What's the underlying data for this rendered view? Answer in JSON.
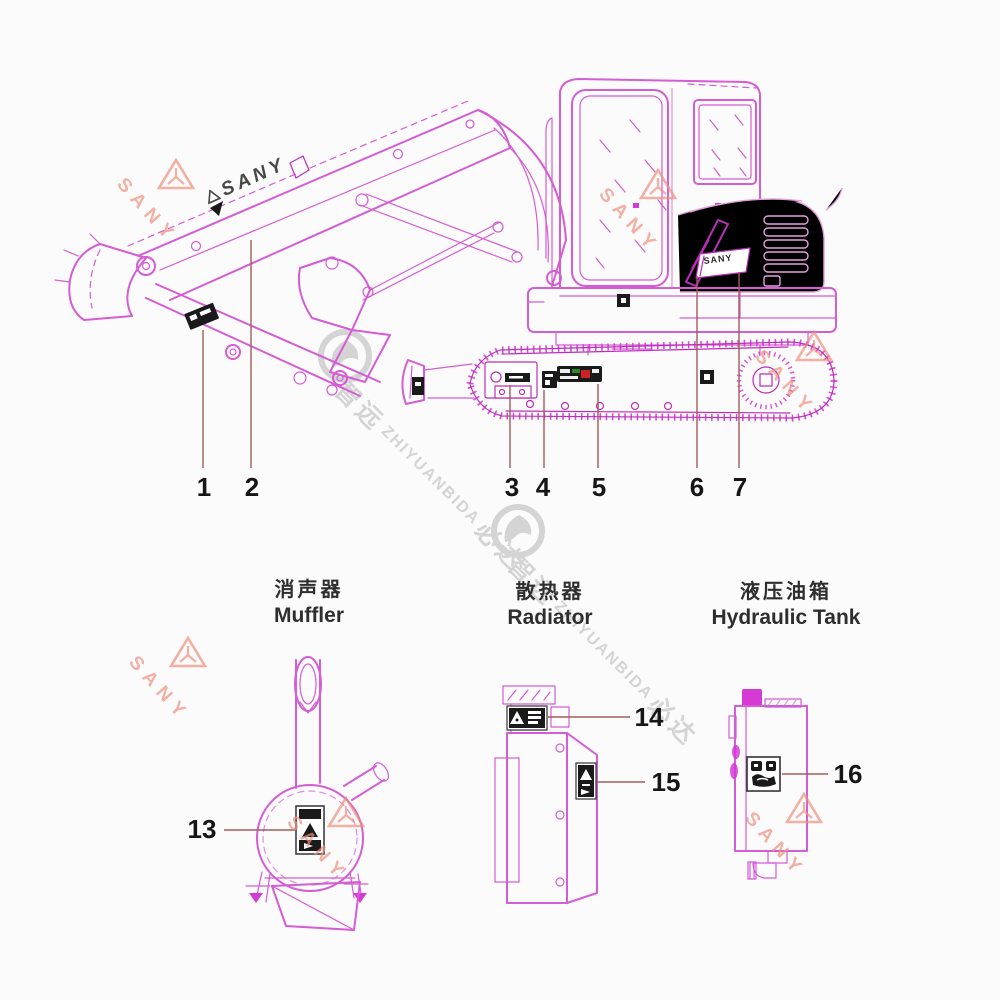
{
  "theme": {
    "line_pink": "#d45cd4",
    "line_pink_dark": "#b92fb9",
    "line_pink_light": "#e5a0dd",
    "track_pink": "#d53ad5",
    "callout_line": "#a15c5c",
    "number_color": "#161616",
    "decal_black": "#1a1a1a",
    "sany_watermark": "#ee8f7c",
    "gray_watermark": "#d4d4d4",
    "title_color": "#2e2e2e",
    "page_bg": "#fcfbfc"
  },
  "excavator": {
    "boom_decal_text": "SANY",
    "engine_decal_text": "SANY",
    "callouts": [
      {
        "num": "1"
      },
      {
        "num": "2"
      },
      {
        "num": "3"
      },
      {
        "num": "4"
      },
      {
        "num": "5"
      },
      {
        "num": "6"
      },
      {
        "num": "7"
      }
    ]
  },
  "components": [
    {
      "name_zh": "消声器",
      "name_en": "Muffler",
      "callouts": [
        {
          "num": "13"
        }
      ]
    },
    {
      "name_zh": "散热器",
      "name_en": "Radiator",
      "callouts": [
        {
          "num": "14"
        },
        {
          "num": "15"
        }
      ]
    },
    {
      "name_zh": "液压油箱",
      "name_en": "Hydraulic Tank",
      "callouts": [
        {
          "num": "16"
        }
      ]
    }
  ],
  "watermarks": {
    "sany_text": "SANY",
    "zybd_zh_lead": "智远",
    "zybd_latin": "ZHIYUANBIDA",
    "zybd_zh_tail": "必达"
  }
}
